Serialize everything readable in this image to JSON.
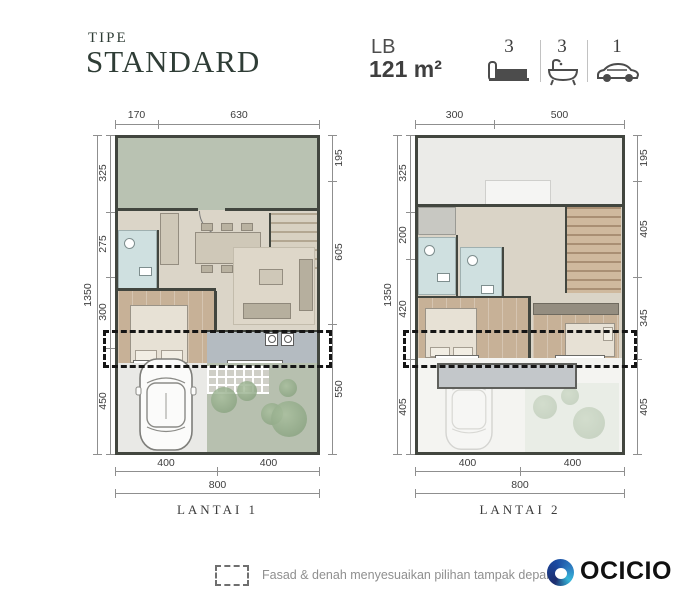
{
  "header": {
    "tipe_label": "TIPE",
    "tipe_value": "STANDARD",
    "lb_label": "LB",
    "lb_value": "121 m²",
    "stats": [
      {
        "icon": "bed-icon",
        "count": "3"
      },
      {
        "icon": "bath-icon",
        "count": "3"
      },
      {
        "icon": "car-icon",
        "count": "1"
      }
    ]
  },
  "plans": {
    "lantai1": {
      "label": "LANTAI 1",
      "dims": {
        "top": [
          "170",
          "630"
        ],
        "left_outer": "1350",
        "left": [
          "325",
          "275",
          "300",
          "450"
        ],
        "right": [
          "195",
          "605",
          "550"
        ],
        "bottom": [
          "400",
          "400"
        ],
        "bottom_total": "800"
      }
    },
    "lantai2": {
      "label": "LANTAI 2",
      "dims": {
        "top": [
          "300",
          "500"
        ],
        "left_outer": "1350",
        "left": [
          "325",
          "200",
          "420",
          "405"
        ],
        "right": [
          "195",
          "405",
          "345",
          "405"
        ],
        "bottom": [
          "400",
          "400"
        ],
        "bottom_total": "800"
      }
    }
  },
  "footer": {
    "note": "Fasad & denah menyesuaikan pilihan tampak depan",
    "logo_text": "OCICIO"
  },
  "colors": {
    "title_green": "#2f3d36",
    "garden_green": "#b9c2b2",
    "wood_floor": "#c7b197",
    "bath_blue": "#cfe0e0",
    "terrace_gray": "#b4bbc1",
    "wall_dark": "#42463f",
    "dashed_black": "#151515",
    "logo_navy": "#1d2d6e",
    "logo_blue": "#2e7fc2",
    "logo_teal": "#35b6d9"
  }
}
